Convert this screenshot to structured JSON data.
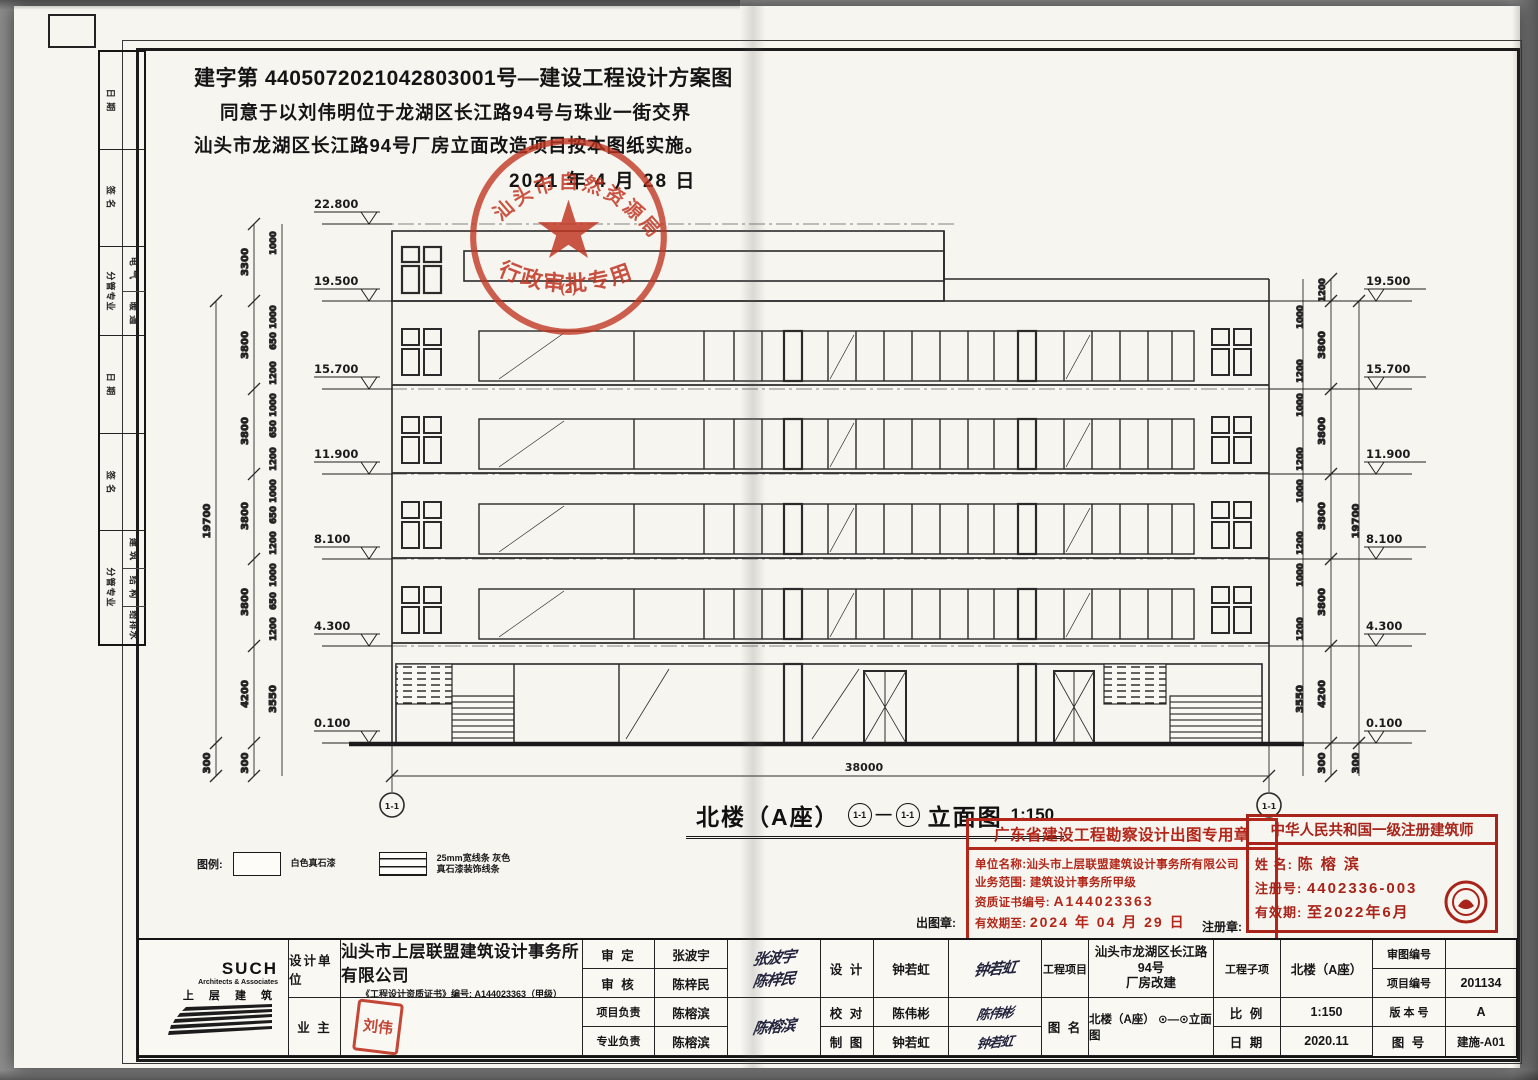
{
  "approval": {
    "line1": "建字第 4405072021042803001号—建设工程设计方案图",
    "line2": "同意于以刘伟明位于龙湖区长江路94号与珠业一街交界",
    "line3": "汕头市龙湖区长江路94号厂房立面改造项目按本图纸实施。",
    "date": "2021 年 4 月 28 日",
    "stamp": {
      "arc_top": "汕头市自然资源局",
      "arc_bottom": "行政审批专用章",
      "sub_mark": "(2)"
    }
  },
  "margin_table": {
    "groups": [
      {
        "label": "日 期",
        "items": []
      },
      {
        "label": "签 名",
        "items": []
      },
      {
        "label": "分管专业",
        "items": [
          "电 气",
          "暖 通"
        ]
      },
      {
        "label": "日 期",
        "items": []
      },
      {
        "label": "签 名",
        "items": []
      },
      {
        "label": "分管专业",
        "items": [
          "建 筑",
          "结 构",
          "给排水"
        ]
      }
    ]
  },
  "drawing": {
    "caption": {
      "name": "北楼（A座）",
      "suffix": "立面图",
      "scale": "1:150"
    },
    "axis_label": "1-1",
    "total_width": "38000",
    "levels_left": [
      "22.800",
      "19.500",
      "15.700",
      "11.900",
      "8.100",
      "4.300",
      "0.100"
    ],
    "levels_right": [
      "19.500",
      "15.700",
      "11.900",
      "8.100",
      "4.300",
      "0.100"
    ],
    "floor_dims": [
      "3300",
      "3800",
      "3800",
      "3800",
      "3800",
      "4200"
    ],
    "total_height_dim": "19700",
    "storefront_dim": "3550",
    "base_dim": "300",
    "parapet_dim": "1200",
    "small_dims": [
      "1000",
      "650",
      "150",
      "800",
      "1200"
    ]
  },
  "legend": {
    "title": "图例:",
    "item1": "白色真石漆",
    "item2": "25mm宽线条 灰色真石漆装饰线条"
  },
  "stamps": {
    "chutuzhang_label": "出图章:",
    "zhucezhang_label": "注册章:",
    "gd": {
      "title": "广东省建设工程勘察设计出图专用章",
      "row1_k": "单位名称:",
      "row1_v": "汕头市上层联盟建筑设计事务所有限公司",
      "row2_k": "业务范围:",
      "row2_v": "建筑设计事务所甲级",
      "row3_k": "资质证书编号:",
      "row3_v": "A144023363",
      "row4_k": "有效期至:",
      "row4_v": "2024 年 04 月 29 日"
    },
    "arch": {
      "title": "中华人民共和国一级注册建筑师",
      "row1_k": "姓  名:",
      "row1_v": "陈 榕 滨",
      "row2_k": "注册号:",
      "row2_v": "4402336-003",
      "row3_k": "有效期:",
      "row3_v": "至2022年6月"
    }
  },
  "titleblock": {
    "logo": {
      "brand": "SUCH",
      "sub": "Architects & Associates",
      "cn": "上 层 建 筑"
    },
    "design_unit_label": "设计单位",
    "company": "汕头市上层联盟建筑设计事务所有限公司",
    "cert": "《工程设计资质证书》编号: A144023363（甲级）",
    "owner_label": "业  主",
    "owner_seal": "刘伟",
    "shending_label": "审  定",
    "shending_name": "张波宇",
    "shenhe_label": "审  核",
    "shenhe_name": "陈梓民",
    "xiangmu_label": "项目负责",
    "xiangmu_name": "陈榕滨",
    "zhuanye_label": "专业负责",
    "zhuanye_name": "陈榕滨",
    "sig_shending": "张波宇",
    "sig_shenhe": "陈梓民",
    "sig_fuze": "陈榕滨",
    "sheji_label": "设  计",
    "sheji_name": "钟若虹",
    "sig_sheji": "钟若虹",
    "jiaodui_label": "校  对",
    "jiaodui_name": "陈伟彬",
    "sig_jiaodui": "陈伟彬",
    "zhitu_label": "制  图",
    "zhitu_name": "钟若虹",
    "sig_zhitu": "钟若虹",
    "project_label": "工程项目",
    "project_line1": "汕头市龙湖区长江路94号",
    "project_line2": "厂房改建",
    "figure_label": "图  名",
    "figure_value": "北楼（A座） ⊙—⊙立面图",
    "subproject_label": "工程子项",
    "subproject_value": "北楼（A座）",
    "scale_label": "比  例",
    "scale_value": "1:150",
    "date_label": "日  期",
    "date_value": "2020.11",
    "review_no_label": "审图编号",
    "review_no_value": "",
    "project_no_label": "项目编号",
    "project_no_value": "201134",
    "version_label": "版 本 号",
    "version_value": "A",
    "sheet_no_label": "图  号",
    "sheet_no_value": "建施-A01"
  }
}
